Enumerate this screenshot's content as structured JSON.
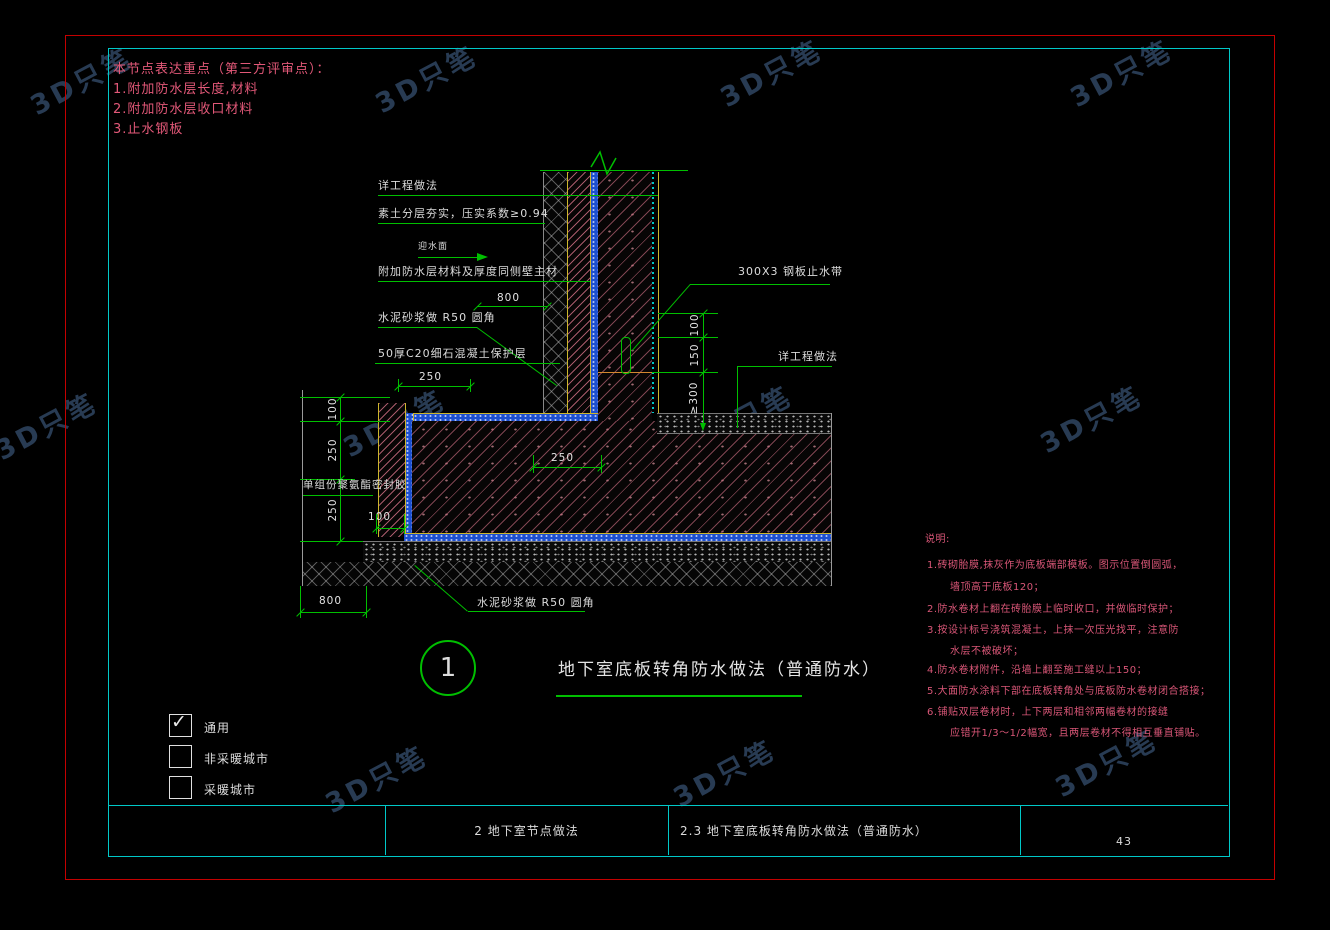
{
  "watermark": {
    "text": "3D只笔"
  },
  "review_notes": {
    "title": "本节点表达重点（第三方评审点）：",
    "items": [
      "1.附加防水层长度,材料",
      "2.附加防水层收口材料",
      "3.止水钢板"
    ]
  },
  "labels": {
    "work_method_left": "详工程做法",
    "soil_compaction": "素土分层夯实，压实系数≥0.94",
    "water_facing_side": "迎水面",
    "additional_membrane": "附加防水层材料及厚度同侧壁主材",
    "mortar_fillet_upper": "水泥砂浆做  R50 圆角",
    "protection_layer": "50厚C20细石混凝土保护层",
    "steel_waterstop": "300X3 钢板止水带",
    "work_method_right": "详工程做法",
    "sealant": "单组份聚氨酯密封胶",
    "mortar_fillet_lower": "水泥砂浆做  R50 圆角"
  },
  "dimensions": {
    "top_800": "800",
    "top_250": "250",
    "right_100": "100",
    "right_150": "150",
    "right_ge300": "≥300",
    "left_100": "100",
    "left_250_a": "250",
    "left_250_b": "250",
    "form_100": "100",
    "slab_250": "250",
    "bottom_800": "800"
  },
  "detail_title": {
    "number": "1",
    "text": "地下室底板转角防水做法（普通防水）"
  },
  "legend": {
    "items": [
      {
        "label": "通用",
        "mark": "✓"
      },
      {
        "label": "非采暖城市",
        "mark": ""
      },
      {
        "label": "采暖城市",
        "mark": ""
      }
    ]
  },
  "site_notes": {
    "title": "说明:",
    "lines": [
      "1.砖砌胎膜,抹灰作为底板端部模板。图示位置倒圆弧，",
      "墙顶高于底板120；",
      "2.防水卷材上翻在砖胎膜上临时收口，并做临时保护；",
      "3.按设计标号浇筑混凝土，上抹一次压光找平，注意防",
      "水层不被破坏；",
      "4.防水卷材附件，沿墙上翻至施工缝以上150；",
      "5.大面防水涂料下部在底板转角处与底板防水卷材闭合搭接；",
      "6.铺贴双层卷材时，上下两层和相邻两幅卷材的接缝",
      "应错开1/3～1/2幅宽，且两层卷材不得相互垂直铺贴。"
    ]
  },
  "title_bar": {
    "col_section": "2  地下室节点做法",
    "col_detail": "2.3  地下室底板转角防水做法（普通防水）",
    "page_number": "43"
  }
}
